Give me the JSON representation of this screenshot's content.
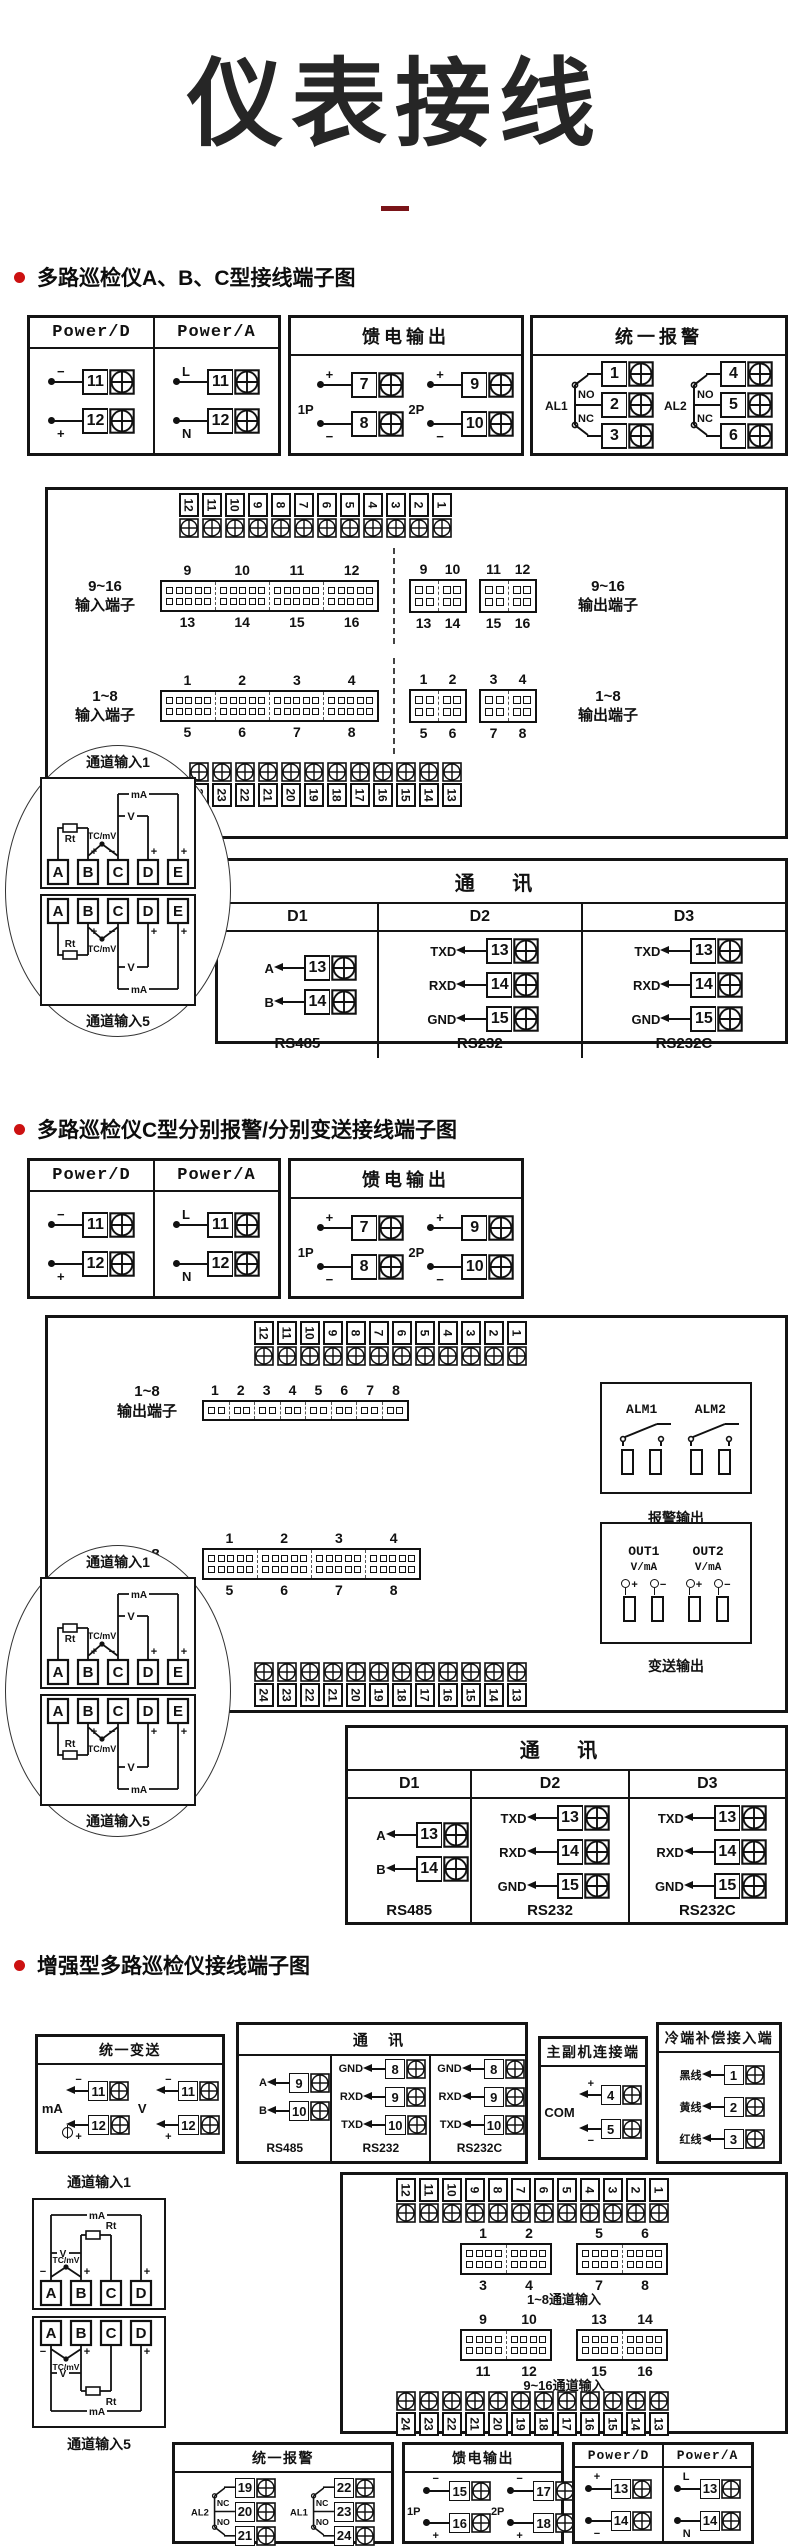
{
  "title": "仪表接线",
  "accent": {
    "bullet_red": "#cc1111",
    "underline_maroon": "#7a1418",
    "ink": "#141414"
  },
  "sections": {
    "s1": {
      "heading": "多路巡检仪A、B、C型接线端子图",
      "power": {
        "cols": [
          {
            "header": "Power/D",
            "terms": [
              {
                "sign": "−",
                "pos": "top",
                "num": "11"
              },
              {
                "sign": "+",
                "pos": "bot",
                "num": "12"
              }
            ]
          },
          {
            "header": "Power/A",
            "terms": [
              {
                "sign": "L",
                "pos": "top",
                "num": "11"
              },
              {
                "sign": "N",
                "pos": "bot",
                "num": "12"
              }
            ]
          }
        ]
      },
      "feed": {
        "header": "馈电输出",
        "groups": [
          {
            "label": "1P",
            "terms": [
              {
                "sign": "+",
                "pos": "top",
                "num": "7"
              },
              {
                "sign": "−",
                "pos": "bot",
                "num": "8"
              }
            ]
          },
          {
            "label": "2P",
            "terms": [
              {
                "sign": "+",
                "pos": "top",
                "num": "9"
              },
              {
                "sign": "−",
                "pos": "bot",
                "num": "10"
              }
            ]
          }
        ]
      },
      "alarm": {
        "header": "统一报警",
        "groups": [
          {
            "label": "AL1",
            "contacts": [
              "NO",
              "NC"
            ],
            "nums": [
              "1",
              "2",
              "3"
            ]
          },
          {
            "label": "AL2",
            "contacts": [
              "NO",
              "NC"
            ],
            "nums": [
              "4",
              "5",
              "6"
            ]
          }
        ]
      },
      "board": {
        "top_strip": [
          "12",
          "11",
          "10",
          "9",
          "8",
          "7",
          "6",
          "5",
          "4",
          "3",
          "2",
          "1"
        ],
        "bottom_strip": [
          "24",
          "23",
          "22",
          "21",
          "20",
          "19",
          "18",
          "17",
          "16",
          "15",
          "14",
          "13"
        ],
        "rows": [
          {
            "left_label": "9~16\n输入端子",
            "right_label": "9~16\n输出端子",
            "top_nums": [
              "9",
              "10",
              "11",
              "12"
            ],
            "bot_nums": [
              "13",
              "14",
              "15",
              "16"
            ],
            "out_top": [
              [
                "9",
                "10"
              ],
              [
                "11",
                "12"
              ]
            ],
            "out_bot": [
              [
                "13",
                "14"
              ],
              [
                "15",
                "16"
              ]
            ]
          },
          {
            "left_label": "1~8\n输入端子",
            "right_label": "1~8\n输出端子",
            "top_nums": [
              "1",
              "2",
              "3",
              "4"
            ],
            "bot_nums": [
              "5",
              "6",
              "7",
              "8"
            ],
            "out_top": [
              [
                "1",
                "2"
              ],
              [
                "3",
                "4"
              ]
            ],
            "out_bot": [
              [
                "5",
                "6"
              ],
              [
                "7",
                "8"
              ]
            ]
          }
        ]
      },
      "balloon": {
        "top_label": "通道输入1",
        "bottom_label": "通道输入5",
        "letters": [
          "A",
          "B",
          "C",
          "D",
          "E"
        ],
        "labels": {
          "rt": "Rt",
          "tc": "TC/mV",
          "v": "V",
          "ma": "mA",
          "plus": "+",
          "minus": "−"
        }
      },
      "comm": {
        "header": "通  讯",
        "cols": [
          {
            "w": "28%",
            "sub": "D1",
            "rows": [
              [
                "A",
                "13"
              ],
              [
                "B",
                "14"
              ]
            ],
            "foot": "RS485"
          },
          {
            "w": "36%",
            "sub": "D2",
            "rows": [
              [
                "TXD",
                "13"
              ],
              [
                "RXD",
                "14"
              ],
              [
                "GND",
                "15"
              ]
            ],
            "foot": "RS232"
          },
          {
            "w": "36%",
            "sub": "D3",
            "rows": [
              [
                "TXD",
                "13"
              ],
              [
                "RXD",
                "14"
              ],
              [
                "GND",
                "15"
              ]
            ],
            "foot": "RS232C"
          }
        ]
      }
    },
    "s2": {
      "heading": "多路巡检仪C型分别报警/分别变送接线端子图",
      "power": {
        "cols": [
          {
            "header": "Power/D",
            "terms": [
              {
                "sign": "−",
                "pos": "top",
                "num": "11"
              },
              {
                "sign": "+",
                "pos": "bot",
                "num": "12"
              }
            ]
          },
          {
            "header": "Power/A",
            "terms": [
              {
                "sign": "L",
                "pos": "top",
                "num": "11"
              },
              {
                "sign": "N",
                "pos": "bot",
                "num": "12"
              }
            ]
          }
        ]
      },
      "feed": {
        "header": "馈电输出",
        "groups": [
          {
            "label": "1P",
            "terms": [
              {
                "sign": "+",
                "pos": "top",
                "num": "7"
              },
              {
                "sign": "−",
                "pos": "bot",
                "num": "8"
              }
            ]
          },
          {
            "label": "2P",
            "terms": [
              {
                "sign": "+",
                "pos": "top",
                "num": "9"
              },
              {
                "sign": "−",
                "pos": "bot",
                "num": "10"
              }
            ]
          }
        ]
      },
      "board": {
        "top_strip": [
          "12",
          "11",
          "10",
          "9",
          "8",
          "7",
          "6",
          "5",
          "4",
          "3",
          "2",
          "1"
        ],
        "bottom_strip": [
          "24",
          "23",
          "22",
          "21",
          "20",
          "19",
          "18",
          "17",
          "16",
          "15",
          "14",
          "13"
        ],
        "out_row": {
          "label": "1~8\n输出端子",
          "nums": [
            "1",
            "2",
            "3",
            "4",
            "5",
            "6",
            "7",
            "8"
          ]
        },
        "in_row": {
          "label": "1~8\n输入端子",
          "top_nums": [
            "1",
            "2",
            "3",
            "4"
          ],
          "bot_nums": [
            "5",
            "6",
            "7",
            "8"
          ]
        },
        "alm": {
          "labels": [
            "ALM1",
            "ALM2"
          ],
          "caption": "报警输出"
        },
        "out": {
          "labels": [
            "OUT1",
            "OUT2"
          ],
          "sub": "V/mA",
          "plus": "+",
          "minus": "−",
          "caption": "变送输出"
        }
      },
      "balloon": {
        "top_label": "通道输入1",
        "bottom_label": "通道输入5",
        "letters": [
          "A",
          "B",
          "C",
          "D",
          "E"
        ],
        "labels": {
          "rt": "Rt",
          "tc": "TC/mV",
          "v": "V",
          "ma": "mA",
          "plus": "+",
          "minus": "−"
        }
      },
      "comm": {
        "header": "通  讯",
        "cols": [
          {
            "w": "28%",
            "sub": "D1",
            "rows": [
              [
                "A",
                "13"
              ],
              [
                "B",
                "14"
              ]
            ],
            "foot": "RS485"
          },
          {
            "w": "36%",
            "sub": "D2",
            "rows": [
              [
                "TXD",
                "13"
              ],
              [
                "RXD",
                "14"
              ],
              [
                "GND",
                "15"
              ]
            ],
            "foot": "RS232"
          },
          {
            "w": "36%",
            "sub": "D3",
            "rows": [
              [
                "TXD",
                "13"
              ],
              [
                "RXD",
                "14"
              ],
              [
                "GND",
                "15"
              ]
            ],
            "foot": "RS232C"
          }
        ]
      }
    },
    "s3": {
      "heading": "增强型多路巡检仪接线端子图",
      "transmit": {
        "header": "统一变送",
        "groups": [
          {
            "label": "mA",
            "meter": true,
            "terms": [
              {
                "sign": "−",
                "pos": "top",
                "num": "11"
              },
              {
                "sign": "+",
                "pos": "bot",
                "num": "12"
              }
            ]
          },
          {
            "label": "V",
            "meter": false,
            "terms": [
              {
                "sign": "−",
                "pos": "top",
                "num": "11"
              },
              {
                "sign": "+",
                "pos": "bot",
                "num": "12"
              }
            ]
          }
        ]
      },
      "comm": {
        "header": "通  讯",
        "cols": [
          {
            "w": "31%",
            "rows": [
              [
                "A",
                "9"
              ],
              [
                "B",
                "10"
              ]
            ],
            "foot": "RS485"
          },
          {
            "w": "34.5%",
            "rows": [
              [
                "GND",
                "8"
              ],
              [
                "RXD",
                "9"
              ],
              [
                "TXD",
                "10"
              ]
            ],
            "foot": "RS232"
          },
          {
            "w": "34.5%",
            "rows": [
              [
                "GND",
                "8"
              ],
              [
                "RXD",
                "9"
              ],
              [
                "TXD",
                "10"
              ]
            ],
            "foot": "RS232C"
          }
        ]
      },
      "master": {
        "header": "主副机连接端",
        "label": "COM",
        "terms": [
          {
            "sign": "+",
            "pos": "top",
            "num": "4"
          },
          {
            "sign": "−",
            "pos": "bot",
            "num": "5"
          }
        ]
      },
      "cold": {
        "header": "冷端补偿接入端",
        "rows": [
          [
            "黑线",
            "1"
          ],
          [
            "黄线",
            "2"
          ],
          [
            "红线",
            "3"
          ]
        ]
      },
      "channels": {
        "top_label": "通道输入1",
        "bottom_label": "通道输入5",
        "letters": [
          "A",
          "B",
          "C",
          "D"
        ],
        "labels": {
          "rt": "Rt",
          "tc": "TC/mV",
          "v": "V",
          "ma": "mA",
          "plus": "+",
          "minus": "−"
        }
      },
      "board": {
        "top_strip": [
          "12",
          "11",
          "10",
          "9",
          "8",
          "7",
          "6",
          "5",
          "4",
          "3",
          "2",
          "1"
        ],
        "bottom_strip": [
          "24",
          "23",
          "22",
          "21",
          "20",
          "19",
          "18",
          "17",
          "16",
          "15",
          "14",
          "13"
        ],
        "rows": [
          {
            "blocks": [
              {
                "top": [
                  "1",
                  "2"
                ],
                "bot": [
                  "3",
                  "4"
                ]
              },
              {
                "top": [
                  "5",
                  "6"
                ],
                "bot": [
                  "7",
                  "8"
                ]
              }
            ],
            "caption": "1~8通道输入"
          },
          {
            "blocks": [
              {
                "top": [
                  "9",
                  "10"
                ],
                "bot": [
                  "11",
                  "12"
                ]
              },
              {
                "top": [
                  "13",
                  "14"
                ],
                "bot": [
                  "15",
                  "16"
                ]
              }
            ],
            "caption": "9~16通道输入"
          }
        ]
      },
      "alarm": {
        "header": "统一报警",
        "groups": [
          {
            "label": "AL2",
            "contacts": [
              "NC",
              "NO"
            ],
            "nums": [
              "19",
              "20",
              "21"
            ]
          },
          {
            "label": "AL1",
            "contacts": [
              "NC",
              "NO"
            ],
            "nums": [
              "22",
              "23",
              "24"
            ]
          }
        ]
      },
      "feed": {
        "header": "馈电输出",
        "groups": [
          {
            "label": "1P",
            "terms": [
              {
                "sign": "−",
                "pos": "top",
                "num": "15"
              },
              {
                "sign": "+",
                "pos": "bot",
                "num": "16"
              }
            ]
          },
          {
            "label": "2P",
            "terms": [
              {
                "sign": "−",
                "pos": "top",
                "num": "17"
              },
              {
                "sign": "+",
                "pos": "bot",
                "num": "18"
              }
            ]
          }
        ]
      },
      "power": {
        "cols": [
          {
            "header": "Power/D",
            "terms": [
              {
                "sign": "+",
                "pos": "top",
                "num": "13"
              },
              {
                "sign": "−",
                "pos": "bot",
                "num": "14"
              }
            ]
          },
          {
            "header": "Power/A",
            "terms": [
              {
                "sign": "L",
                "pos": "top",
                "num": "13"
              },
              {
                "sign": "N",
                "pos": "bot",
                "num": "14"
              }
            ]
          }
        ]
      }
    }
  }
}
